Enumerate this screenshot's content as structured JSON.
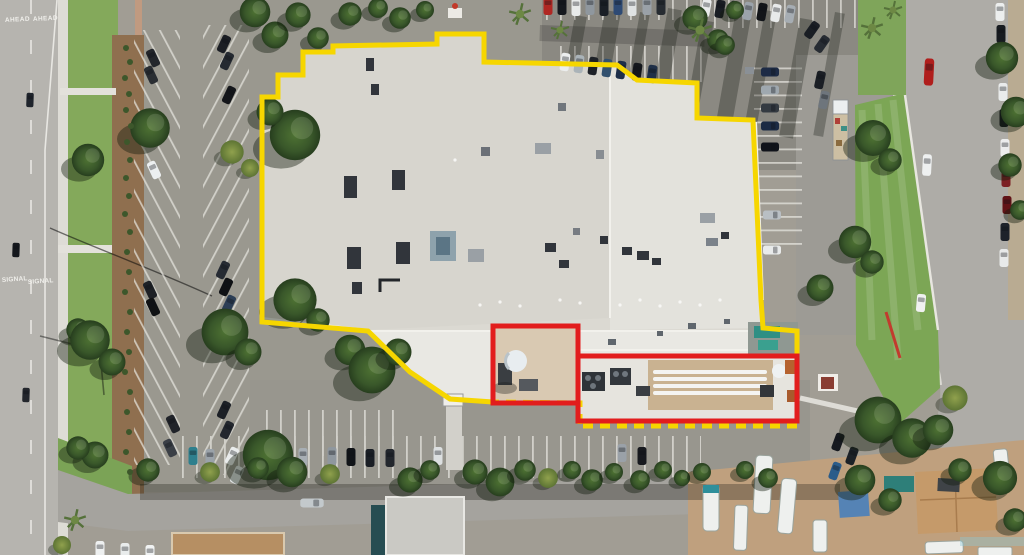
{
  "scene": {
    "type": "aerial-photo",
    "description": "Oblique aerial photograph of a large single-story commercial building outlined in yellow, with two red rectangles marking rooftop/ground equipment areas on the south side; surrounded by parking lots, streets, landscaping and an RV yard"
  },
  "road_markings": {
    "lane1_ahead": "AHEAD",
    "lane2_ahead": "AHEAD",
    "lane1_signal": "SIGNAL",
    "lane2_signal": "SIGNAL"
  },
  "annotations": {
    "property_outline_color": "#f6d600",
    "property_outline_width": "5",
    "equipment_outline_color": "#e21d1d",
    "equipment_outline_width": "5"
  },
  "palette": {
    "roof_main": "#dbd9d2",
    "roof_left": "#d7d5ce",
    "roof_right": "#e3e2dc",
    "roof_south_wing": "#e9e8e3",
    "asphalt_light": "#b6b4af",
    "asphalt_lot": "#9a988f",
    "asphalt_dark": "#8b8982",
    "plaza_tan": "#c59c82",
    "lawn_green": "#84a95b",
    "mulch_brown": "#8f6f4f",
    "rv_yard_tan": "#bfa07e"
  }
}
